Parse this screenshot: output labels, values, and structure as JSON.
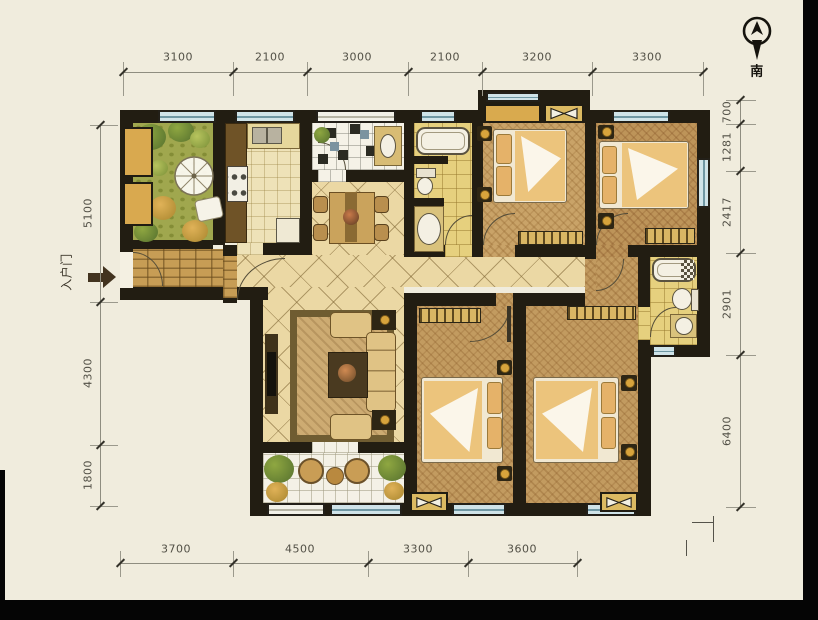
{
  "compass": {
    "south_label": "南"
  },
  "entry": {
    "door_label": "入户门"
  },
  "dimensions": {
    "top": [
      "3100",
      "2100",
      "3000",
      "2100",
      "3200",
      "3300"
    ],
    "bottom": [
      "3700",
      "4500",
      "3300",
      "3600"
    ],
    "left": [
      "5100",
      "4300",
      "1800"
    ],
    "right": [
      "700",
      "1281",
      "2417",
      "2901",
      "6400"
    ]
  },
  "palette": {
    "paper": "#f0ecdd",
    "wall": "#221d12",
    "grass": "#a0a74e",
    "hall_tile": "#ebd8a4",
    "carpet": "#c49e63",
    "bath_tile": "#e6d07e",
    "window_glass": "#cfe3e8"
  }
}
